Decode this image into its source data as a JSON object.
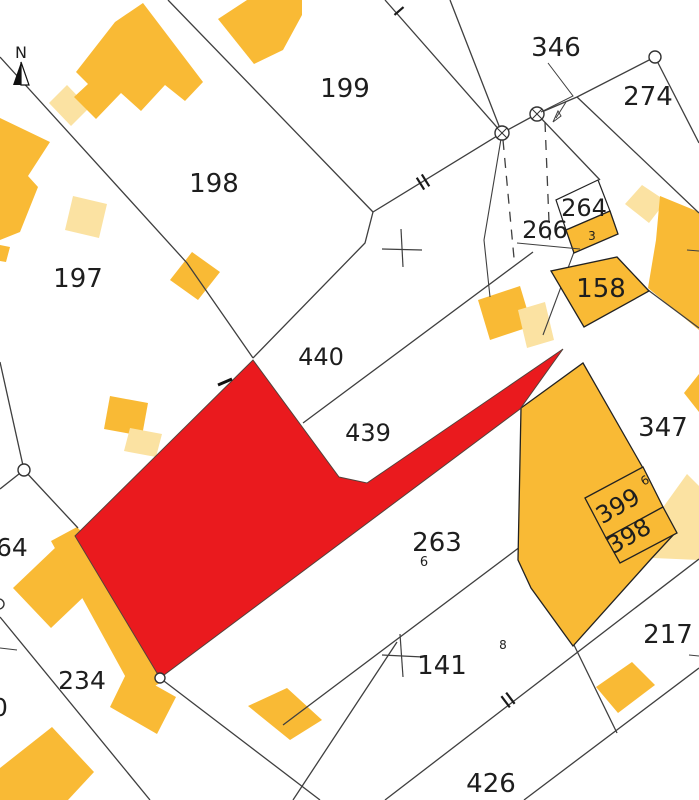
{
  "map": {
    "type": "cadastral-parcel-map",
    "north_label": "N",
    "selected_parcel": "highlighted in red",
    "colors": {
      "background": "#FFFFFF",
      "building": "#F9BA35",
      "building_light": "#FBE2A2",
      "selected_highlight": "#EA1A1E",
      "boundary_line": "#3F3F3F",
      "label_text": "#1E1E1E",
      "small_label_red": "#6B1B10"
    },
    "parcel_numbers": [
      "197",
      "198",
      "199",
      "346",
      "274",
      "264",
      "266",
      "158",
      "440",
      "439",
      "347",
      "399",
      "398",
      "263",
      "141",
      "217",
      "234",
      "426",
      "64",
      "0"
    ],
    "labels": [
      {
        "name": "north-letter",
        "text": "N",
        "x": 21,
        "y": 58,
        "size": 16,
        "rot": 0,
        "anchor": "middle",
        "color": "#111111"
      },
      {
        "name": "parcel-label-199",
        "text": "199",
        "x": 345,
        "y": 97,
        "size": 26,
        "rot": 0,
        "anchor": "middle",
        "color": "#1e1e1e"
      },
      {
        "name": "parcel-label-198",
        "text": "198",
        "x": 214,
        "y": 192,
        "size": 26,
        "rot": 0,
        "anchor": "middle",
        "color": "#1e1e1e"
      },
      {
        "name": "parcel-label-197",
        "text": "197",
        "x": 78,
        "y": 287,
        "size": 26,
        "rot": 0,
        "anchor": "middle",
        "color": "#1e1e1e"
      },
      {
        "name": "parcel-label-346",
        "text": "346",
        "x": 556,
        "y": 56,
        "size": 26,
        "rot": 0,
        "anchor": "middle",
        "color": "#1e1e1e"
      },
      {
        "name": "parcel-label-274",
        "text": "274",
        "x": 648,
        "y": 105,
        "size": 26,
        "rot": 0,
        "anchor": "middle",
        "color": "#1e1e1e"
      },
      {
        "name": "parcel-label-264",
        "text": "264",
        "x": 584,
        "y": 216,
        "size": 24,
        "rot": 0,
        "anchor": "middle",
        "color": "#1e1e1e"
      },
      {
        "name": "parcel-label-266",
        "text": "266",
        "x": 545,
        "y": 238,
        "size": 24,
        "rot": 0,
        "anchor": "middle",
        "color": "#1e1e1e"
      },
      {
        "name": "parcel-label-158",
        "text": "158",
        "x": 601,
        "y": 297,
        "size": 26,
        "rot": 0,
        "anchor": "middle",
        "color": "#1e1e1e"
      },
      {
        "name": "parcel-label-440",
        "text": "440",
        "x": 321,
        "y": 365,
        "size": 24,
        "rot": 0,
        "anchor": "middle",
        "color": "#1e1e1e"
      },
      {
        "name": "parcel-label-439",
        "text": "439",
        "x": 368,
        "y": 441,
        "size": 24,
        "rot": 0,
        "anchor": "middle",
        "color": "#1e1e1e"
      },
      {
        "name": "parcel-label-347",
        "text": "347",
        "x": 663,
        "y": 436,
        "size": 26,
        "rot": 0,
        "anchor": "middle",
        "color": "#1e1e1e"
      },
      {
        "name": "parcel-label-399",
        "text": "399",
        "x": 622,
        "y": 513,
        "size": 24,
        "rot": -30,
        "anchor": "middle",
        "color": "#1e1e1e"
      },
      {
        "name": "parcel-label-398",
        "text": "398",
        "x": 633,
        "y": 543,
        "size": 24,
        "rot": -30,
        "anchor": "middle",
        "color": "#1e1e1e"
      },
      {
        "name": "sub-label-399-6",
        "text": "6",
        "x": 647,
        "y": 484,
        "size": 12,
        "rot": -30,
        "anchor": "middle",
        "color": "#1e1e1e"
      },
      {
        "name": "parcel-label-263",
        "text": "263",
        "x": 437,
        "y": 551,
        "size": 26,
        "rot": 0,
        "anchor": "middle",
        "color": "#1e1e1e"
      },
      {
        "name": "sub-label-263-6",
        "text": "6",
        "x": 424,
        "y": 566,
        "size": 13,
        "rot": 0,
        "anchor": "middle",
        "color": "#1e1e1e"
      },
      {
        "name": "parcel-label-141",
        "text": "141",
        "x": 442,
        "y": 674,
        "size": 26,
        "rot": 0,
        "anchor": "middle",
        "color": "#1e1e1e"
      },
      {
        "name": "sub-label-141-8",
        "text": "8",
        "x": 503,
        "y": 649,
        "size": 12,
        "rot": 0,
        "anchor": "middle",
        "color": "#1e1e1e"
      },
      {
        "name": "parcel-label-217",
        "text": "217",
        "x": 668,
        "y": 643,
        "size": 26,
        "rot": 0,
        "anchor": "middle",
        "color": "#1e1e1e"
      },
      {
        "name": "parcel-label-234",
        "text": "234",
        "x": 82,
        "y": 689,
        "size": 25,
        "rot": 0,
        "anchor": "middle",
        "color": "#1e1e1e"
      },
      {
        "name": "parcel-label-426",
        "text": "426",
        "x": 491,
        "y": 792,
        "size": 26,
        "rot": 0,
        "anchor": "middle",
        "color": "#1e1e1e"
      },
      {
        "name": "parcel-label-64-clipped",
        "text": "64",
        "x": -4,
        "y": 556,
        "size": 25,
        "rot": 0,
        "anchor": "start",
        "color": "#1e1e1e"
      },
      {
        "name": "parcel-label-0-clipped",
        "text": "0",
        "x": -8,
        "y": 716,
        "size": 25,
        "rot": 0,
        "anchor": "start",
        "color": "#1e1e1e"
      },
      {
        "name": "sub-label-3",
        "text": "3",
        "x": 592,
        "y": 240,
        "size": 12,
        "rot": 0,
        "anchor": "middle",
        "color": "#6b1b10"
      }
    ]
  }
}
